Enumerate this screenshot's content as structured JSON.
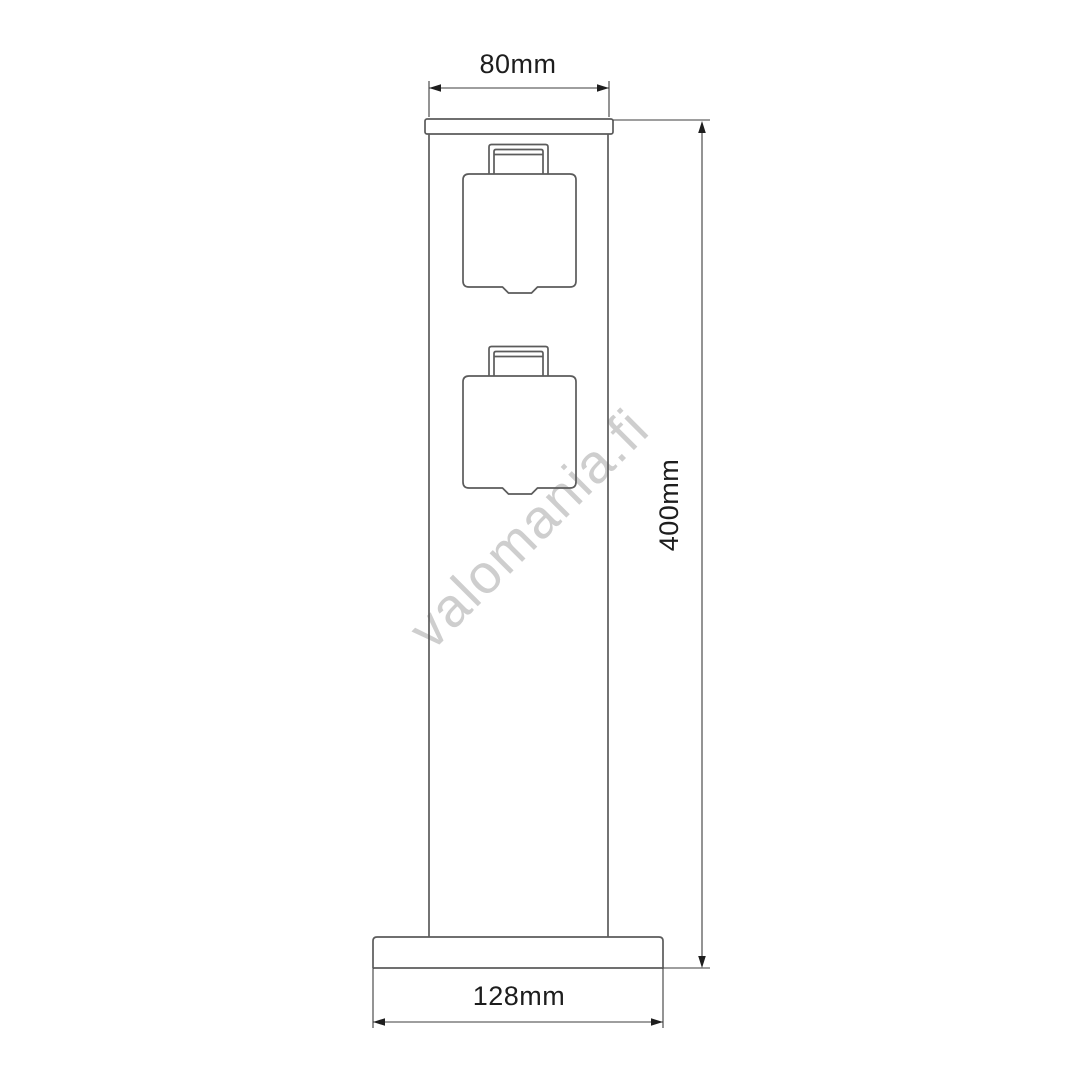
{
  "page": {
    "background": "#ffffff"
  },
  "drawing": {
    "type": "technical-dimension-diagram",
    "object_label": "outdoor-socket-pillar-with-two-covered-outlets",
    "socket_count": 2,
    "dimensions": {
      "top_width": "80mm",
      "height": "400mm",
      "base_width": "128mm"
    },
    "watermark": "valomania.fi",
    "colors": {
      "outline": "#5b5b5b",
      "dimension": "#3c3c3c",
      "arrow": "#1e1e1e",
      "label": "#1d1d1d",
      "watermark": "#c6c6c6",
      "background": "#ffffff"
    }
  }
}
